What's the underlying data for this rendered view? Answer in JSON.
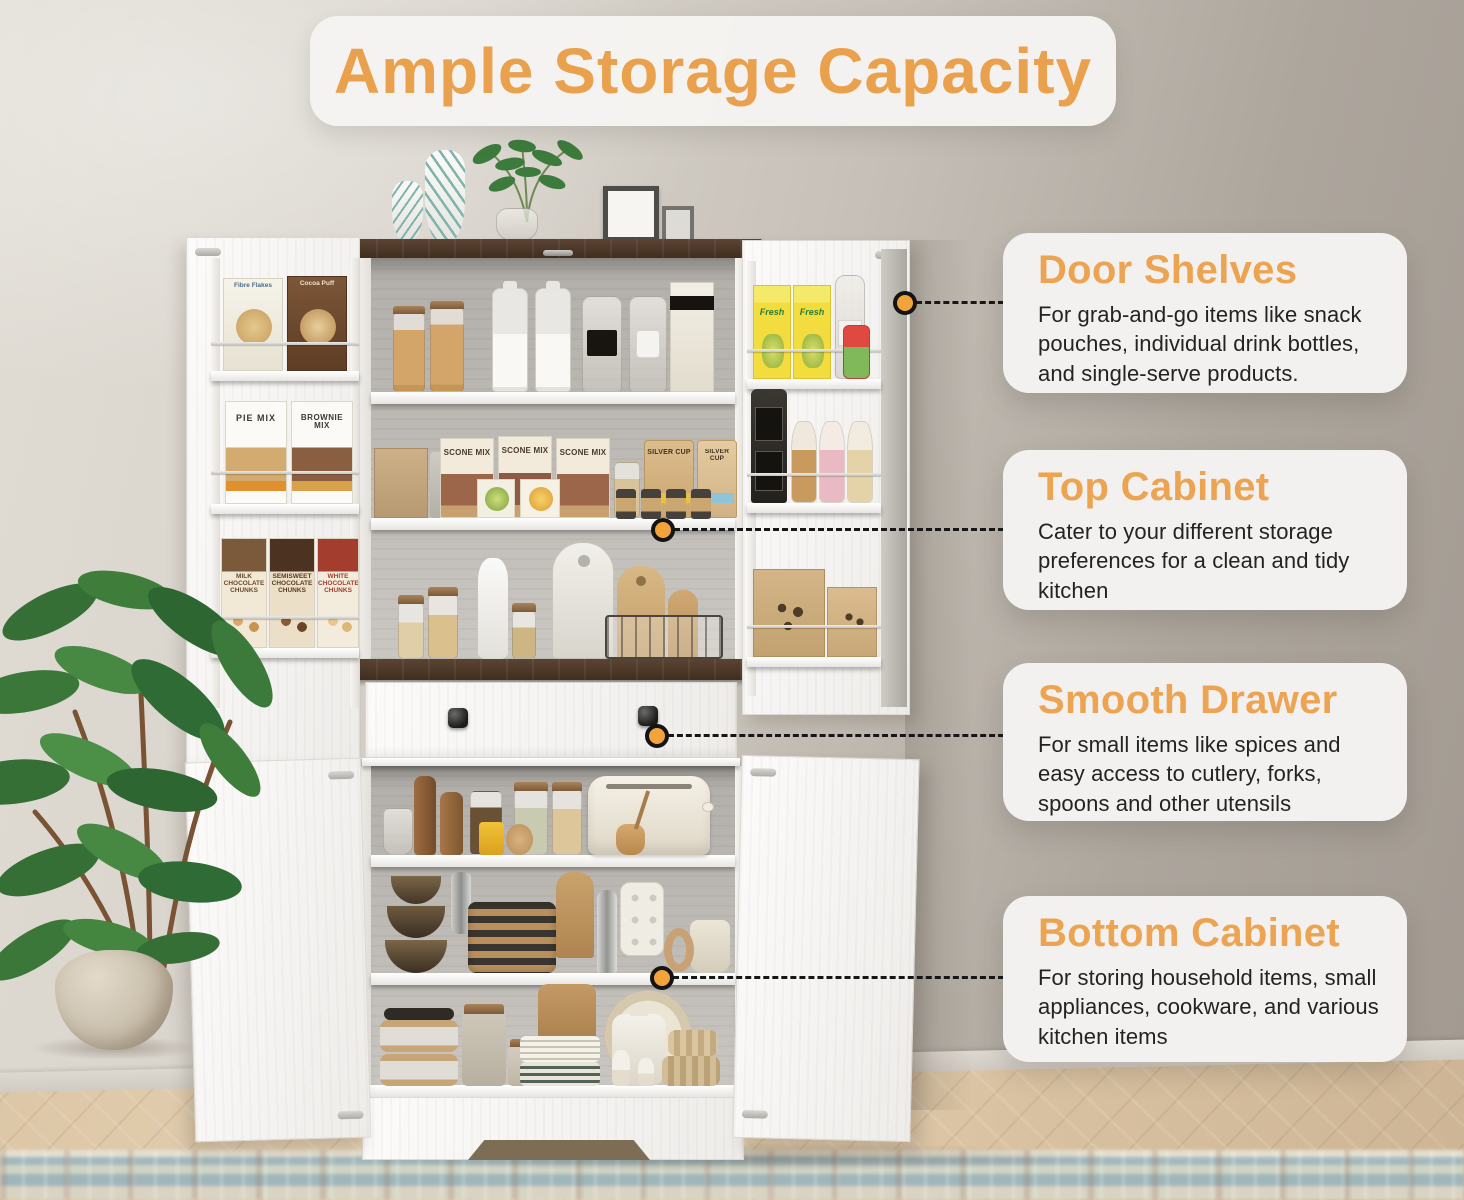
{
  "title": {
    "text": "Ample Storage Capacity"
  },
  "callouts": [
    {
      "heading": "Door Shelves",
      "body": "For grab-and-go items like snack pouches, individual drink bottles, and single-serve products."
    },
    {
      "heading": "Top Cabinet",
      "body": "Cater to your different storage preferences for a clean and tidy kitchen"
    },
    {
      "heading": "Smooth Drawer",
      "body": "For small items like spices and easy access to cutlery, forks, spoons and other utensils"
    },
    {
      "heading": "Bottom Cabinet",
      "body": "For storing household items, small appliances, cookware, and various kitchen items"
    }
  ],
  "packaging": {
    "fibre_flakes": "Fibre Flakes",
    "cocoa_puff": "Cocoa Puff",
    "pie_mix": "PIE MIX",
    "brownie_mix": "BROWNIE MIX",
    "milk_chunks": "MILK CHOCOLATE CHUNKS",
    "semisweet_chunks": "SEMISWEET CHOCOLATE CHUNKS",
    "white_chunks": "WHITE CHOCOLATE CHUNKS",
    "scone_mix": "SCONE MIX",
    "silver_cup": "SILVER CUP",
    "fresh": "Fresh"
  },
  "colors": {
    "accent_orange": "#ECA452",
    "title_text": "#E9A14E",
    "callout_bg": "#F2F1EF",
    "body_text": "#232323",
    "dot_fill": "#F2A33C",
    "dot_ring": "#141414",
    "wood_brown": "#4D382B",
    "cabinet_white": "#F5F4F2",
    "wall": "#C9C4BD"
  }
}
